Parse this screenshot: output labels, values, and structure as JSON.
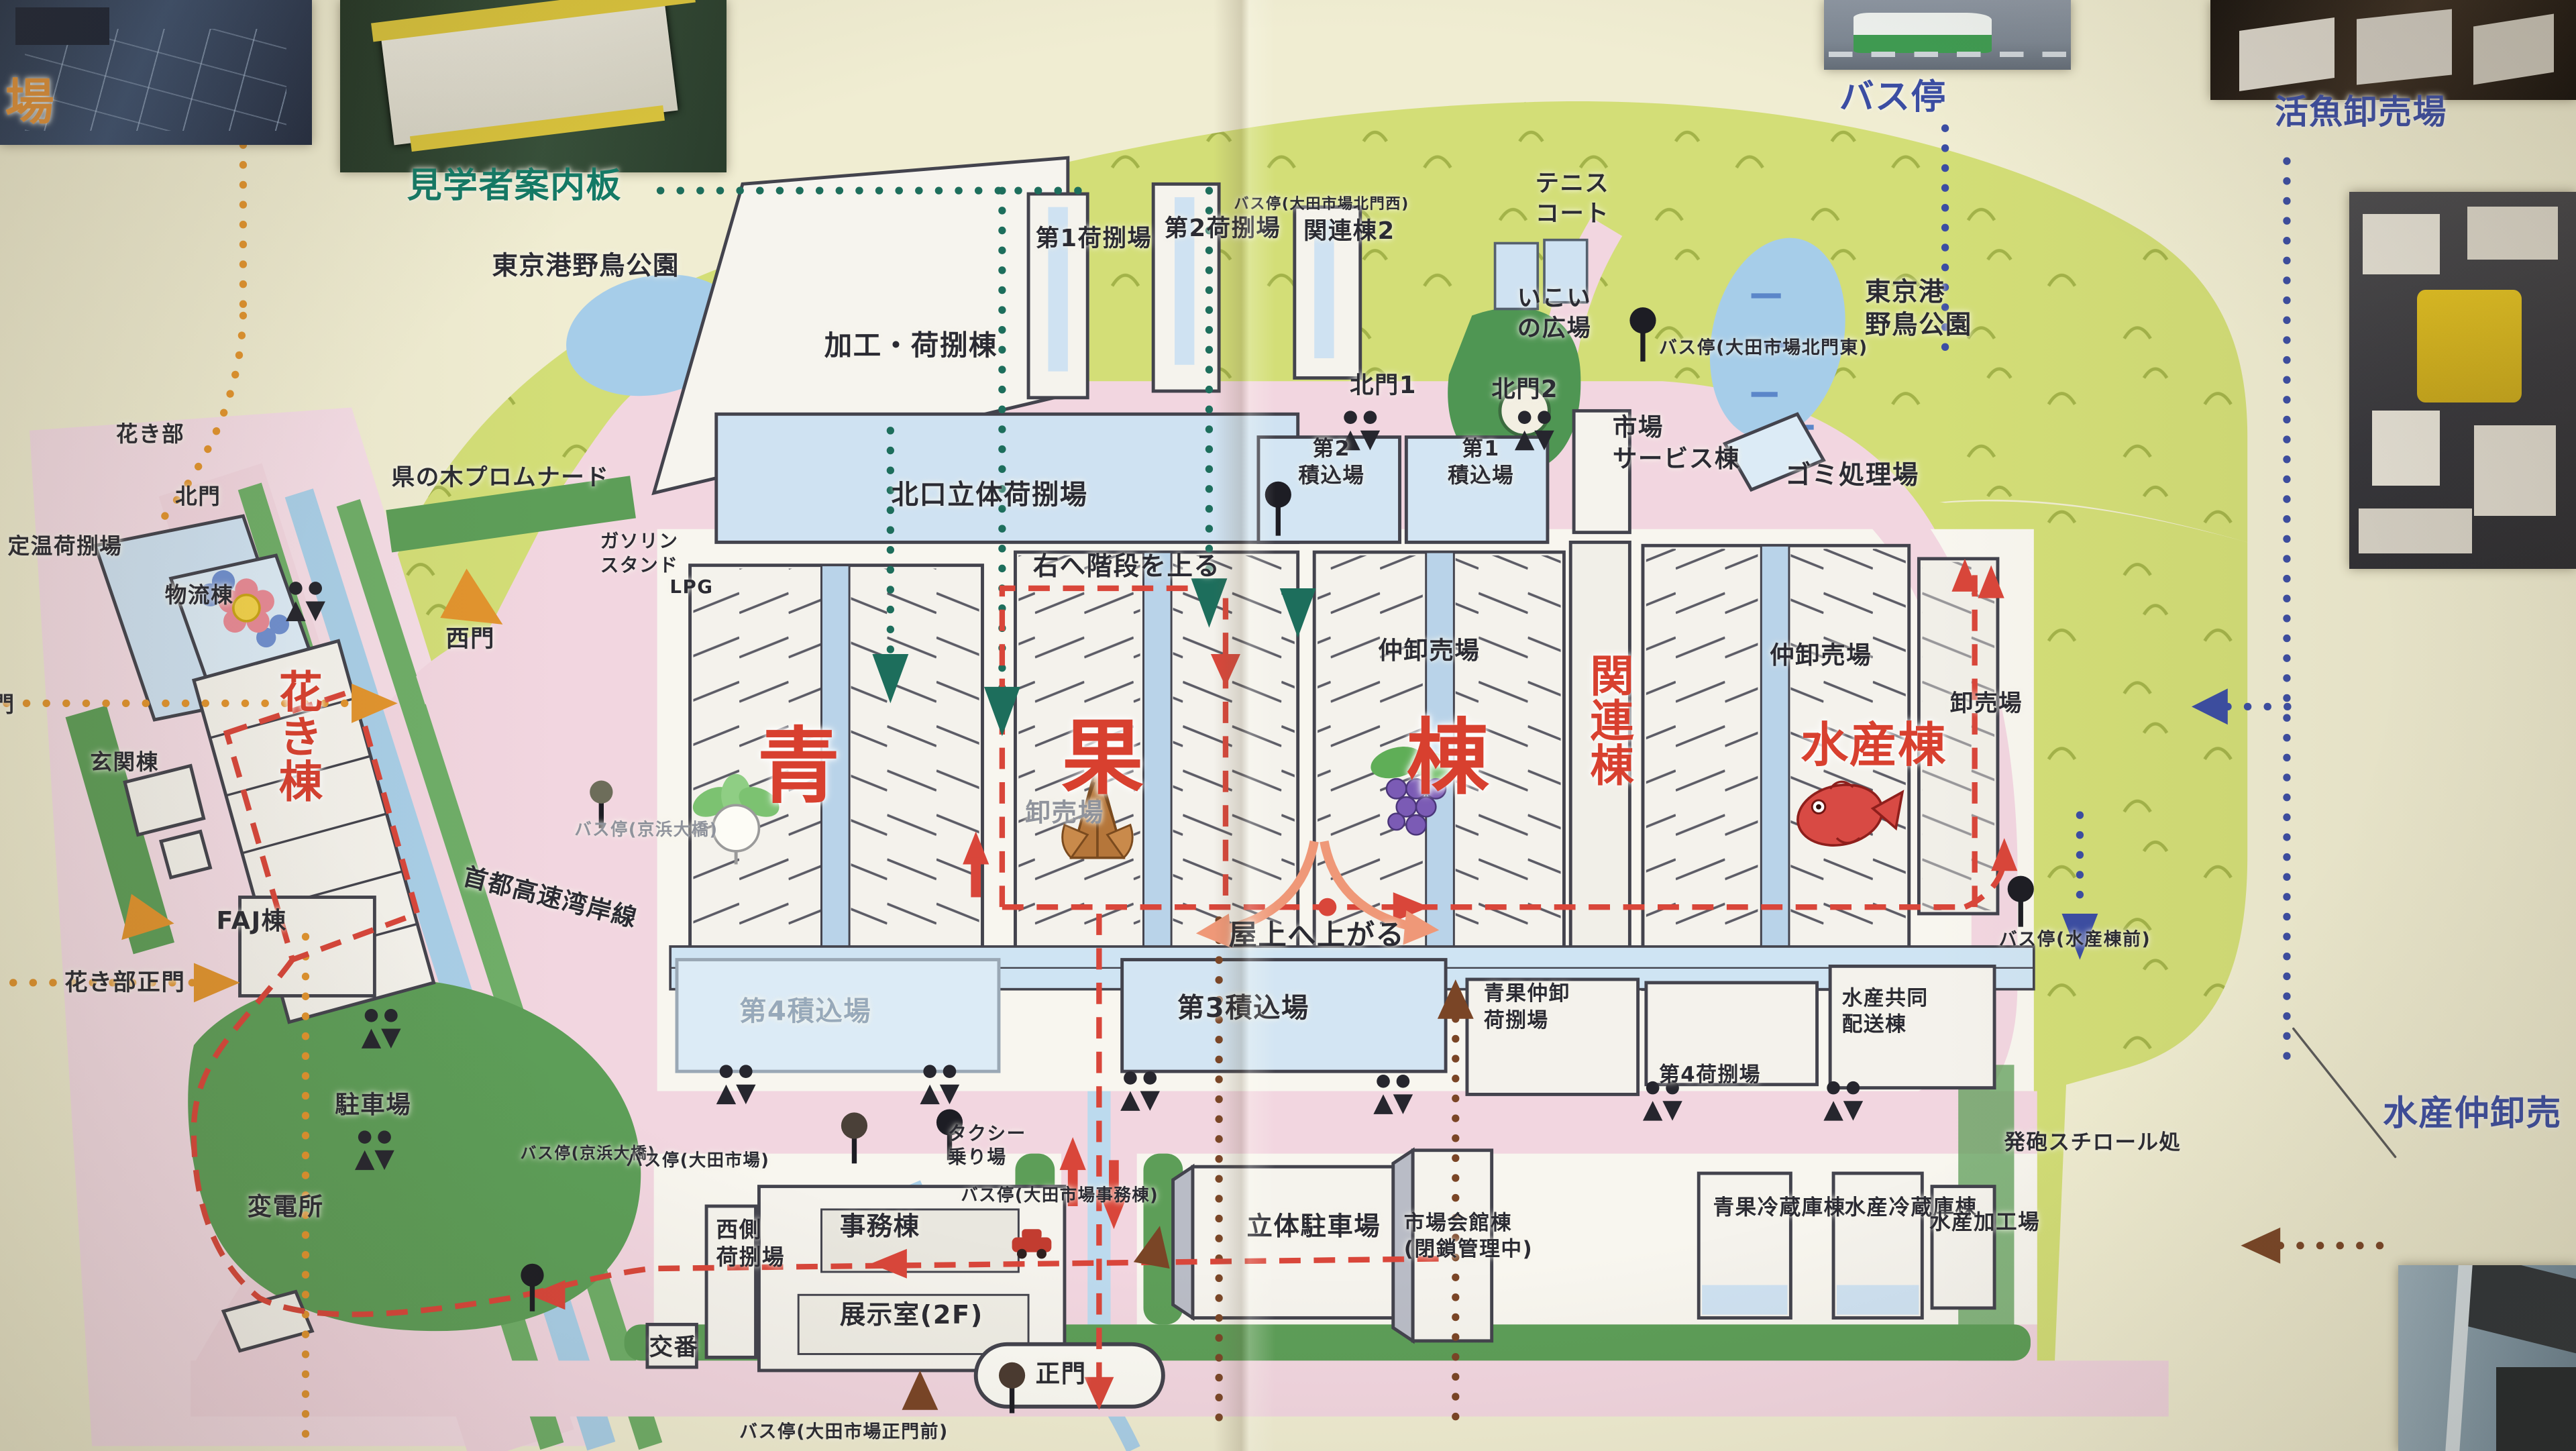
{
  "map_subject": "大田市場 構内案内図",
  "palette": {
    "paper": "#f0edd2",
    "park": "#d3de77",
    "road_pink": "#f2d6e0",
    "building_white": "#f5f3ed",
    "building_blue": "#cfe2f2",
    "water": "#a9cfe8",
    "dark_green": "#5d9e58",
    "label_red": "#d8402f",
    "label_blue": "#3b4da3",
    "label_green": "#147a66",
    "label_orange": "#e0913a",
    "route_red": "#d9463a",
    "dots_orange": "#e2942e",
    "dots_green": "#1d6e5c",
    "dots_blue": "#3b4da3",
    "dots_brown": "#7a4526",
    "arrow_salmon": "#ef9878"
  },
  "labels": [
    {
      "name": "photo-caption-ichiba",
      "text": "場",
      "x": 0.2,
      "y": 4.9,
      "cls": "orange",
      "size": 1.9
    },
    {
      "name": "photo-caption-guide-board",
      "text": "見学者案内板",
      "x": 15.8,
      "y": 11.3,
      "cls": "green",
      "size": 1.35
    },
    {
      "name": "photo-caption-bus-stop",
      "text": "バス停",
      "x": 71.4,
      "y": 5.2,
      "cls": "blue",
      "size": 1.35
    },
    {
      "name": "photo-caption-live-fish",
      "text": "活魚卸売場",
      "x": 88.3,
      "y": 6.3,
      "cls": "blue",
      "size": 1.3
    },
    {
      "name": "photo-caption-fish-wholesale",
      "text": "水産仲卸売",
      "x": 92.5,
      "y": 75.2,
      "cls": "blue",
      "size": 1.35
    },
    {
      "name": "label-bird-park-west",
      "text": "東京港野鳥公園",
      "x": 19.1,
      "y": 17.2,
      "size": 1.0
    },
    {
      "name": "label-processing-bldg",
      "text": "加工・荷捌棟",
      "x": 32.0,
      "y": 22.6,
      "size": 1.08
    },
    {
      "name": "label-no1-cargo",
      "text": "第1荷捌場",
      "x": 40.2,
      "y": 15.4,
      "size": 0.92,
      "vert": true
    },
    {
      "name": "label-no2-cargo",
      "text": "第2荷捌場",
      "x": 45.2,
      "y": 14.7,
      "size": 0.92,
      "vert": true
    },
    {
      "name": "label-busstop-kitamon-nishi",
      "text": "バス停(大田市場北門西)",
      "x": 47.9,
      "y": 13.4,
      "size": 0.58,
      "vert": true
    },
    {
      "name": "label-kanren-2",
      "text": "関連棟2",
      "x": 50.6,
      "y": 14.9,
      "size": 0.92,
      "vert": true
    },
    {
      "name": "label-kitamon-1",
      "text": "北門1",
      "x": 52.4,
      "y": 25.5,
      "size": 0.92
    },
    {
      "name": "label-kitamon-2",
      "text": "北門2",
      "x": 57.9,
      "y": 25.8,
      "size": 0.92
    },
    {
      "name": "label-tennis-court",
      "text": "テニス\nコート",
      "x": 59.6,
      "y": 11.6,
      "size": 0.92
    },
    {
      "name": "label-ikoi-plaza",
      "text": "いこい\nの広場",
      "x": 58.9,
      "y": 19.5,
      "size": 0.92
    },
    {
      "name": "label-busstop-kitamon-higashi",
      "text": "バス停(大田市場北門東)",
      "x": 64.4,
      "y": 23.2,
      "size": 0.7
    },
    {
      "name": "label-bird-park-east",
      "text": "東京港\n野鳥公園",
      "x": 72.4,
      "y": 19.0,
      "size": 1.0
    },
    {
      "name": "label-gomi",
      "text": "ゴミ処理場",
      "x": 69.3,
      "y": 31.6,
      "size": 1.0
    },
    {
      "name": "label-service-bldg",
      "text": "市場\nサービス棟",
      "x": 62.6,
      "y": 28.4,
      "size": 0.95
    },
    {
      "name": "label-tsumikomi-2",
      "text": "第2\n積込場",
      "x": 50.4,
      "y": 30.0,
      "size": 0.82,
      "cls": "ctr"
    },
    {
      "name": "label-tsumikomi-1",
      "text": "第1\n積込場",
      "x": 56.2,
      "y": 30.0,
      "size": 0.82,
      "cls": "ctr"
    },
    {
      "name": "label-kitaguchi-rittai",
      "text": "北口立体荷捌場",
      "x": 34.6,
      "y": 32.9,
      "size": 1.05
    },
    {
      "name": "label-stairs-note",
      "text": "右へ階段を上る",
      "x": 40.1,
      "y": 37.9,
      "size": 1.0
    },
    {
      "name": "label-promenade",
      "text": "県の木プロムナード",
      "x": 15.2,
      "y": 31.9,
      "size": 0.9
    },
    {
      "name": "label-gas-station",
      "text": "ガソリン\nスタンド",
      "x": 23.3,
      "y": 36.5,
      "size": 0.72
    },
    {
      "name": "label-lpg",
      "text": "LPG",
      "x": 26.0,
      "y": 39.6,
      "size": 0.72
    },
    {
      "name": "label-nishimon",
      "text": "西門",
      "x": 17.3,
      "y": 43.0,
      "size": 0.92
    },
    {
      "name": "label-busstop-keihin-w",
      "text": "バス停(京浜大橋)",
      "x": 22.3,
      "y": 56.4,
      "size": 0.66,
      "cls": "gray"
    },
    {
      "name": "label-expressway",
      "text": "首都高速湾岸線",
      "x": 17.9,
      "y": 60.8,
      "size": 0.95,
      "vert": true,
      "rot": 14
    },
    {
      "name": "label-busstop-keihin-s",
      "text": "バス停(京浜大橋)",
      "x": 20.2,
      "y": 78.8,
      "size": 0.62,
      "vert": true
    },
    {
      "name": "label-hall-ao",
      "text": "青",
      "x": 29.4,
      "y": 49.2,
      "cls": "red huge"
    },
    {
      "name": "label-hall-ka",
      "text": "果",
      "x": 41.2,
      "y": 48.6,
      "cls": "red huge"
    },
    {
      "name": "label-hall-tou",
      "text": "棟",
      "x": 54.6,
      "y": 48.6,
      "cls": "red huge"
    },
    {
      "name": "label-kanren",
      "text": "関連棟",
      "x": 61.3,
      "y": 45.0,
      "cls": "red vert",
      "size": 1.7
    },
    {
      "name": "label-suisan-tou",
      "text": "水産棟",
      "x": 69.9,
      "y": 49.3,
      "cls": "red",
      "size": 1.85
    },
    {
      "name": "label-nakaoroshi-c",
      "text": "仲卸売場",
      "x": 53.5,
      "y": 43.8,
      "size": 0.95
    },
    {
      "name": "label-nakaoroshi-d",
      "text": "仲卸売場",
      "x": 68.7,
      "y": 44.1,
      "size": 0.95
    },
    {
      "name": "label-oroshi-a",
      "text": "卸売場",
      "x": 39.8,
      "y": 54.9,
      "size": 0.98,
      "cls": "gray"
    },
    {
      "name": "label-oroshi-d",
      "text": "卸売場",
      "x": 75.7,
      "y": 47.5,
      "size": 0.9
    },
    {
      "name": "label-rooftop-note",
      "text": "屋上へ上がる",
      "x": 47.7,
      "y": 63.2,
      "size": 1.1
    },
    {
      "name": "label-tsumikomi-4",
      "text": "第4積込場",
      "x": 28.7,
      "y": 68.5,
      "size": 1.05,
      "cls": "faint"
    },
    {
      "name": "label-tsumikomi-3",
      "text": "第3積込場",
      "x": 45.7,
      "y": 68.3,
      "size": 1.05
    },
    {
      "name": "label-seika-nakaoroshi",
      "text": "青果仲卸\n荷捌場",
      "x": 57.6,
      "y": 67.6,
      "size": 0.8
    },
    {
      "name": "label-cargo-4",
      "text": "第4荷捌場",
      "x": 64.4,
      "y": 73.2,
      "size": 0.8
    },
    {
      "name": "label-suisan-kyodo",
      "text": "水産共同\n配送棟",
      "x": 71.5,
      "y": 67.9,
      "size": 0.8
    },
    {
      "name": "label-taxi-stand",
      "text": "タクシー\n乗り場",
      "x": 36.8,
      "y": 77.3,
      "size": 0.72
    },
    {
      "name": "label-busstop-ota",
      "text": "バス停(大田市場)",
      "x": 24.3,
      "y": 79.2,
      "size": 0.66
    },
    {
      "name": "label-busstop-jimu",
      "text": "バス停(大田市場事務棟)",
      "x": 37.3,
      "y": 81.6,
      "size": 0.66
    },
    {
      "name": "label-nishigawa",
      "text": "西側\n荷捌場",
      "x": 27.8,
      "y": 83.8,
      "size": 0.85
    },
    {
      "name": "label-jimu",
      "text": "事務棟",
      "x": 32.6,
      "y": 83.4,
      "size": 1.0
    },
    {
      "name": "label-tenji",
      "text": "展示室(2F)",
      "x": 32.6,
      "y": 89.5,
      "size": 1.0
    },
    {
      "name": "label-koban",
      "text": "交番",
      "x": 25.2,
      "y": 91.8,
      "size": 0.92
    },
    {
      "name": "label-seimon",
      "text": "正門",
      "x": 40.2,
      "y": 93.6,
      "size": 0.95
    },
    {
      "name": "label-busstop-seimon",
      "text": "バス停(大田市場正門前)",
      "x": 28.7,
      "y": 97.9,
      "size": 0.7
    },
    {
      "name": "label-rittai-parking",
      "text": "立体駐車場",
      "x": 48.4,
      "y": 83.4,
      "size": 1.0
    },
    {
      "name": "label-kaikan",
      "text": "市場会館棟\n(閉鎖管理中)",
      "x": 54.5,
      "y": 83.4,
      "size": 0.8
    },
    {
      "name": "label-seika-reizo",
      "text": "青果冷蔵庫棟",
      "x": 66.5,
      "y": 82.3,
      "size": 0.82,
      "vert": true
    },
    {
      "name": "label-suisan-reizo",
      "text": "水産冷蔵庫棟",
      "x": 71.6,
      "y": 82.3,
      "size": 0.82,
      "vert": true
    },
    {
      "name": "label-suisan-kako",
      "text": "水産加工場",
      "x": 74.9,
      "y": 83.3,
      "size": 0.82,
      "vert": true
    },
    {
      "name": "label-happo",
      "text": "発砲スチロール処",
      "x": 77.8,
      "y": 77.8,
      "size": 0.82,
      "vert": true
    },
    {
      "name": "label-busstop-suisan",
      "text": "バス停(水産棟前)",
      "x": 77.6,
      "y": 64.0,
      "size": 0.7
    },
    {
      "name": "label-kaki-bu",
      "text": "花き部",
      "x": 4.5,
      "y": 29.0,
      "size": 0.85
    },
    {
      "name": "label-kaki-kitamon",
      "text": "北門",
      "x": 6.8,
      "y": 33.3,
      "size": 0.85
    },
    {
      "name": "label-teion",
      "text": "定温荷捌場",
      "x": 0.3,
      "y": 36.7,
      "size": 0.85
    },
    {
      "name": "label-butsuryu",
      "text": "物流棟",
      "x": 6.4,
      "y": 40.1,
      "size": 0.85
    },
    {
      "name": "label-minamimon",
      "text": "門",
      "x": -0.3,
      "y": 47.6,
      "size": 0.85
    },
    {
      "name": "label-genkan",
      "text": "玄関棟",
      "x": 3.5,
      "y": 51.6,
      "size": 0.85
    },
    {
      "name": "label-kaki-tou",
      "text": "花き棟",
      "x": 10.4,
      "y": 46.1,
      "cls": "red vert",
      "size": 1.7
    },
    {
      "name": "label-faj",
      "text": "FAJ棟",
      "x": 8.4,
      "y": 62.4,
      "size": 0.95
    },
    {
      "name": "label-kaki-seimon",
      "text": "花き部正門",
      "x": 2.5,
      "y": 66.7,
      "size": 0.9
    },
    {
      "name": "label-parking",
      "text": "駐車場",
      "x": 13.0,
      "y": 75.1,
      "size": 0.95
    },
    {
      "name": "label-henden",
      "text": "変電所",
      "x": 9.6,
      "y": 82.1,
      "size": 0.95
    }
  ]
}
